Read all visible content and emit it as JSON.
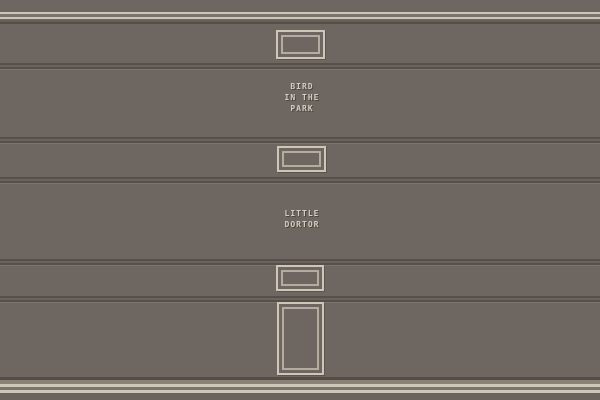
{
  "scene": {
    "colors": {
      "wall": "#6e6761",
      "stripe_light": "#cdc7ba",
      "stripe_dark": "#554e47",
      "upper_dark": "#665f59",
      "molding_gap": "#7b746d",
      "baseboard_tan": "#8a8177",
      "bottom_gray": "#6b645e",
      "groove_dark": "#57504a",
      "groove_mid": "#6b645e",
      "groove_highlight": "#7d766f",
      "frame_outer": "#cdc7ba",
      "frame_inner": "#b3ac9f",
      "text": "#d3cdc0",
      "text_shadow": "#4c463f"
    }
  },
  "labels": {
    "painting_top": {
      "line1": "BIRD",
      "line2": "IN THE",
      "line3": "PARK"
    },
    "painting_bottom": {
      "line1": "LITTLE",
      "line2": "DORTOR"
    }
  }
}
